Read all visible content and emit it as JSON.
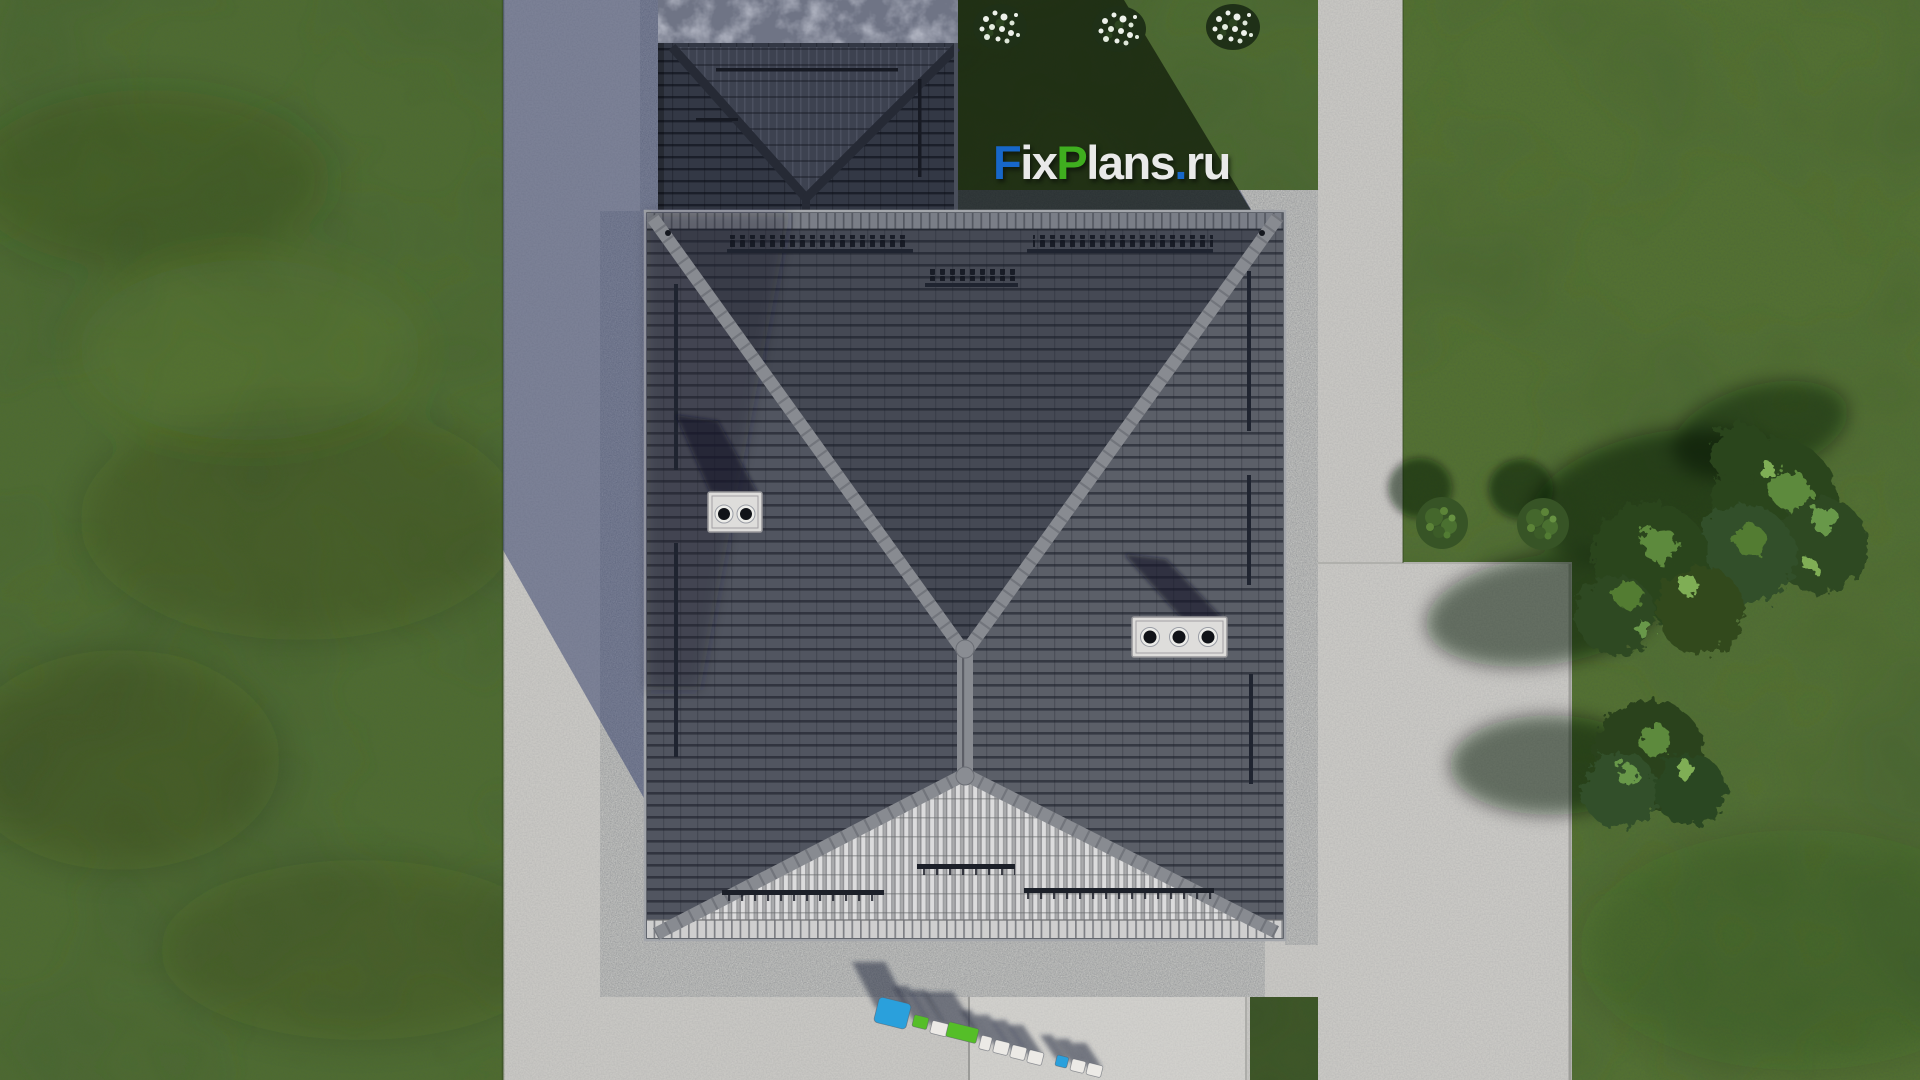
{
  "scene": {
    "type": "3d-architectural-render",
    "view": "top-down aerial roof plan of a house plot",
    "elements": {
      "main_roof": "large dark hipped roof with X ridge pattern",
      "annex_roof": "smaller shadowed roof with valley at north side",
      "chimneys": [
        {
          "position": "west slope",
          "flues": 2
        },
        {
          "position": "east slope",
          "flues": 3
        }
      ],
      "landscaping": "lawn, flower bushes, shrubs and trees",
      "paving": "concrete walkway on west, driveway pads on east and south"
    }
  },
  "watermark": {
    "text": "FixPlans.ru",
    "parts": [
      {
        "text": "F",
        "color": "#1767c9"
      },
      {
        "text": "ix",
        "color": "#e9e9e9"
      },
      {
        "text": "P",
        "color": "#3fae1f"
      },
      {
        "text": "lans",
        "color": "#e9e9e9"
      },
      {
        "text": ".",
        "color": "#1767c9"
      },
      {
        "text": "ru",
        "color": "#e9e9e9"
      }
    ]
  },
  "watermark_3d": {
    "text": "FixPlans.ru",
    "style": "extruded 3D letters standing on the front pavement"
  },
  "palette": {
    "grass": "#4e6b31",
    "grass_shadow": "#1f3116",
    "path": "#c9c8c4",
    "path_shadow": "#7c8196",
    "gravel": "#b4b5b3",
    "roof_north": "#454954",
    "roof_west": "#515560",
    "roof_east": "#5b5f68",
    "roof_south_sunlit": "#b4b5b6",
    "ridge": "#888b91",
    "annex_roof": "#333845",
    "stone_band": "#6f7485",
    "concrete_pad": "#cac9c5",
    "letter_blue": "#2aa0dc",
    "letter_green": "#55be28",
    "letter_white": "#eceae6",
    "logo_blue": "#1767c9",
    "logo_green": "#3fae1f",
    "logo_white": "#e9e9e9"
  }
}
